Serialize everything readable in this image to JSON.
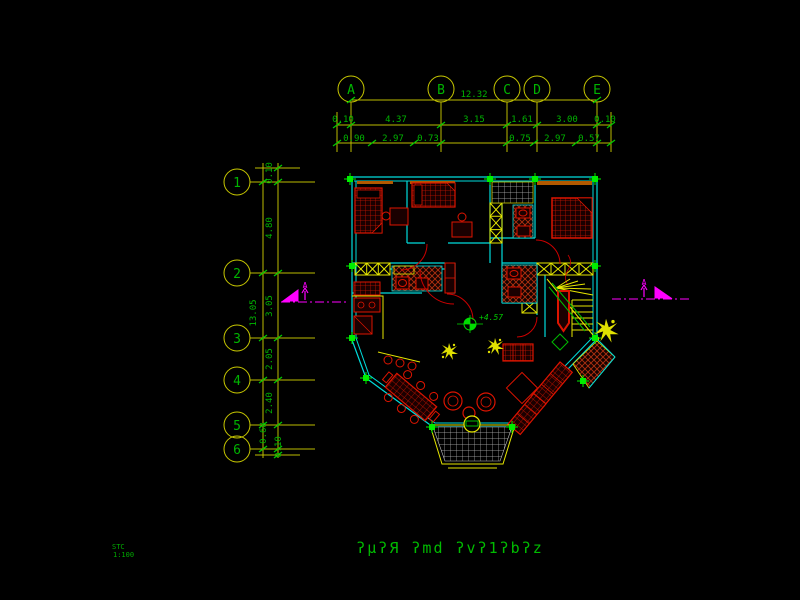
{
  "drawing": {
    "top_axis": {
      "labels": [
        "A",
        "B",
        "C",
        "D",
        "E"
      ],
      "overall_dim": "12.32",
      "dims": [
        "0.10",
        "4.37",
        "3.15",
        "1.61",
        "3.00",
        "0.10"
      ],
      "sub_dims": [
        "0.90",
        "2.97",
        "0.73",
        "0.75",
        "2.97",
        "0.57"
      ]
    },
    "left_axis": {
      "labels": [
        "1",
        "2",
        "3",
        "4",
        "5",
        "6"
      ],
      "overall_dim": "13.05",
      "dims": [
        "0.10",
        "4.80",
        "3.05",
        "2.05",
        "2.40",
        "0.68",
        "0.10"
      ]
    },
    "annotations": {
      "level_marker": "+4.57",
      "section_left": "A",
      "section_right": "A"
    },
    "footer": {
      "title": "ʔμʔЯ ʔmd ʔvʔ1ʔbʔz",
      "note_line1": "STC",
      "note_line2": "1:100"
    },
    "colors": {
      "walls": "#00dcdc",
      "dim_lines": "#bcbc00",
      "dim_text": "#00b400",
      "furniture": "#dd1400",
      "markers": "#00ee00",
      "section": "#ff00ff",
      "lintel": "#b25900",
      "features": "#e6e600"
    }
  }
}
